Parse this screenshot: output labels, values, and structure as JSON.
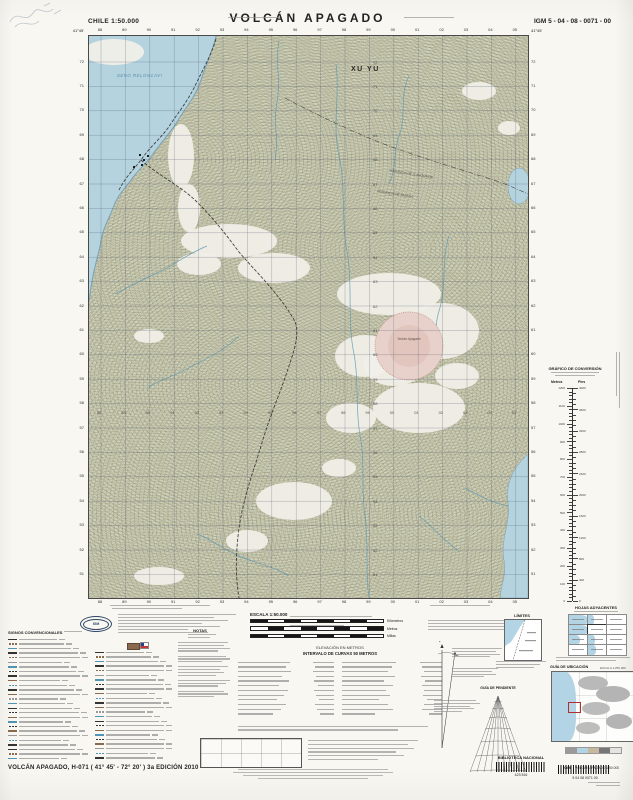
{
  "header": {
    "country_scale": "CHILE  1:50.000",
    "title": "VOLCÁN  APAGADO",
    "sheet_code": "IGM 5 - 04 - 08 - 0071 - 00"
  },
  "map": {
    "corner_lat": "41°45'",
    "sea_label": "SENO RELONCAVÍ",
    "annotation": "XU YU",
    "province_1": "PROVINCIA DE LLANQUIHUE",
    "province_2": "PROVINCIA DE PALENA",
    "volcano_label": "Volcán Apagado",
    "grid": {
      "eastings": [
        "88",
        "89",
        "90",
        "91",
        "92",
        "93",
        "94",
        "95",
        "96",
        "97",
        "98",
        "99",
        "00",
        "01",
        "02",
        "03",
        "04",
        "05"
      ],
      "northings": [
        "72",
        "71",
        "70",
        "69",
        "68",
        "67",
        "66",
        "65",
        "64",
        "63",
        "62",
        "61",
        "60",
        "59",
        "58",
        "57",
        "56",
        "55",
        "54",
        "53",
        "52",
        "51"
      ]
    }
  },
  "marginalia": {
    "legend_title": "SIGNOS CONVENCIONALES",
    "notes_title": "NOTAS",
    "scale_title": "ESCALA 1:50.000",
    "scalebar_units": [
      "Kilómetros",
      "Metros",
      "Millas"
    ],
    "elevation_note": "ELEVACIÓN EN METROS",
    "interval_note": "INTERVALO DE CURVAS 50 METROS",
    "limits_title": "LÍMITES",
    "adjacent_title": "HOJAS ADYACENTES",
    "location_title": "GUÍA DE UBICACIÓN",
    "location_scale": "ESCALA 1:250.000",
    "slope_title": "GUÍA DE PENDIENTE",
    "conversion_title": "GRÁFICO DE CONVERSIÓN",
    "conversion_left": "Metros",
    "conversion_right": "Pies",
    "conversion_metros": [
      "1200",
      "1100",
      "1000",
      "900",
      "800",
      "700",
      "600",
      "500",
      "400",
      "300",
      "200",
      "100",
      "0"
    ],
    "conversion_pies": [
      "4000",
      "3600",
      "3200",
      "2800",
      "2400",
      "2000",
      "1600",
      "1200",
      "800",
      "400",
      "0"
    ]
  },
  "footer": {
    "sheet_title": "VOLCÁN  APAGADO, H-071 ( 41° 45' - 72° 20' )  3a EDICIÓN 2010",
    "library_label": "BIBLIOTECA NACIONAL",
    "library_code": "423 516",
    "igm_abbr": "IGM",
    "igm_sheet_label": "VOLCÁN APAGADO   1:50.000",
    "igm_sheet_numbers": "5    04    08    0071    00"
  },
  "colors": {
    "sea": "#b3d4e4",
    "land": "#cbd3bd",
    "white_patch": "#f4f3ee",
    "contour": "#8b7756",
    "crater": "#e9cfc9",
    "grid": "#3c4a66",
    "river": "#4f93b5"
  }
}
